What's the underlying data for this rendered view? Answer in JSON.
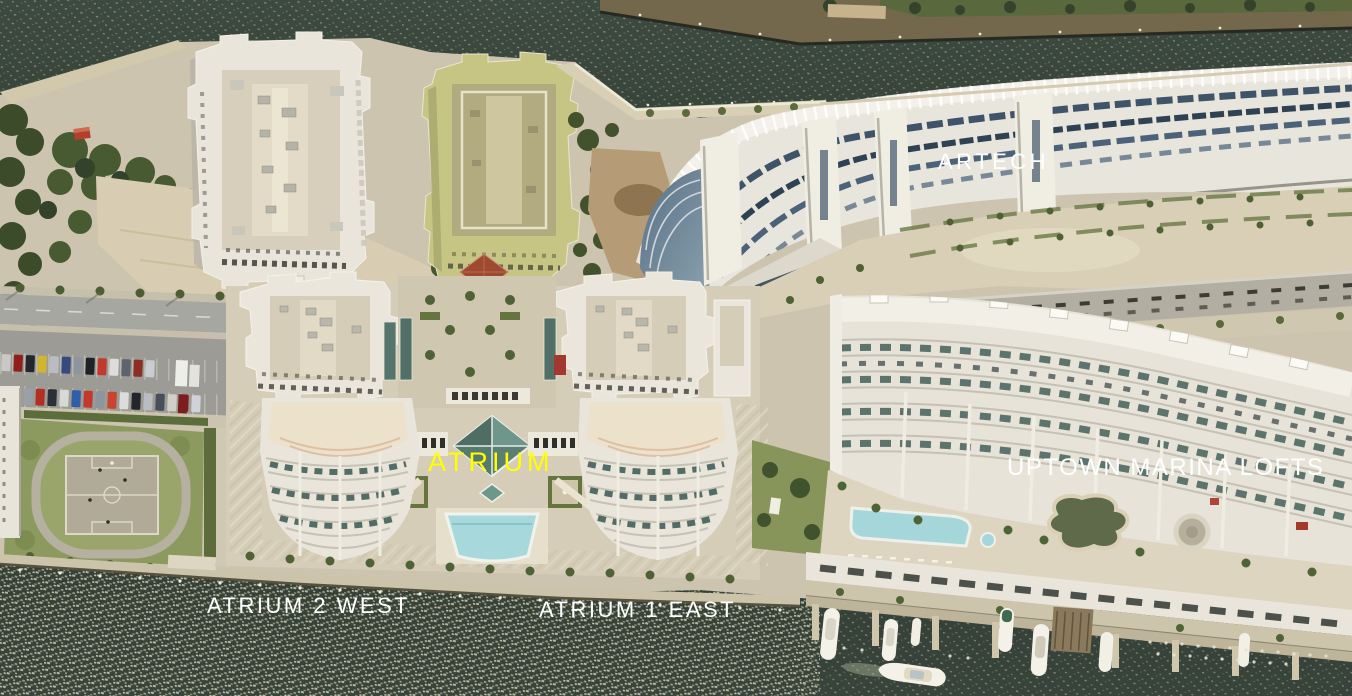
{
  "title": "Bird's-eye aerial photo of waterfront condominium buildings on a canal",
  "labels": {
    "artech": {
      "text": "ARTECH",
      "color": "#ffffff"
    },
    "atrium": {
      "text": "ATRIUM",
      "color": "#ffff00"
    },
    "uptown_marina_lofts": {
      "text": "UPTOWN MARINA LOFTS",
      "color": "#ffffff"
    },
    "atrium_2_west": {
      "text": "ATRIUM 2 WEST",
      "color": "#ffffff"
    },
    "atrium_1_east": {
      "text": "ATRIUM 1 EAST",
      "color": "#ffffff"
    }
  },
  "scene": {
    "water_color": "#36423a",
    "sun_glint_color": "#e6e0c4",
    "building_white": "#eae6dc",
    "building_yellow_green": "#c6c583",
    "artech_window_band": "#44576b",
    "teal_glass": "#4e6e64",
    "pool_color": "#a7d8dc",
    "lawn_color": "#87945a",
    "features": [
      "canal water with sun glint",
      "white condo tower (top left)",
      "yellow-green condo tower",
      "curved ARTECH building with window bands",
      "Atrium twin towers with glass pyramid and pool",
      "Uptown Marina Lofts with pool deck",
      "surface parking lot with cars",
      "basketball court with oval track",
      "marina docks with white yachts",
      "palm trees and waterfront promenades"
    ]
  }
}
